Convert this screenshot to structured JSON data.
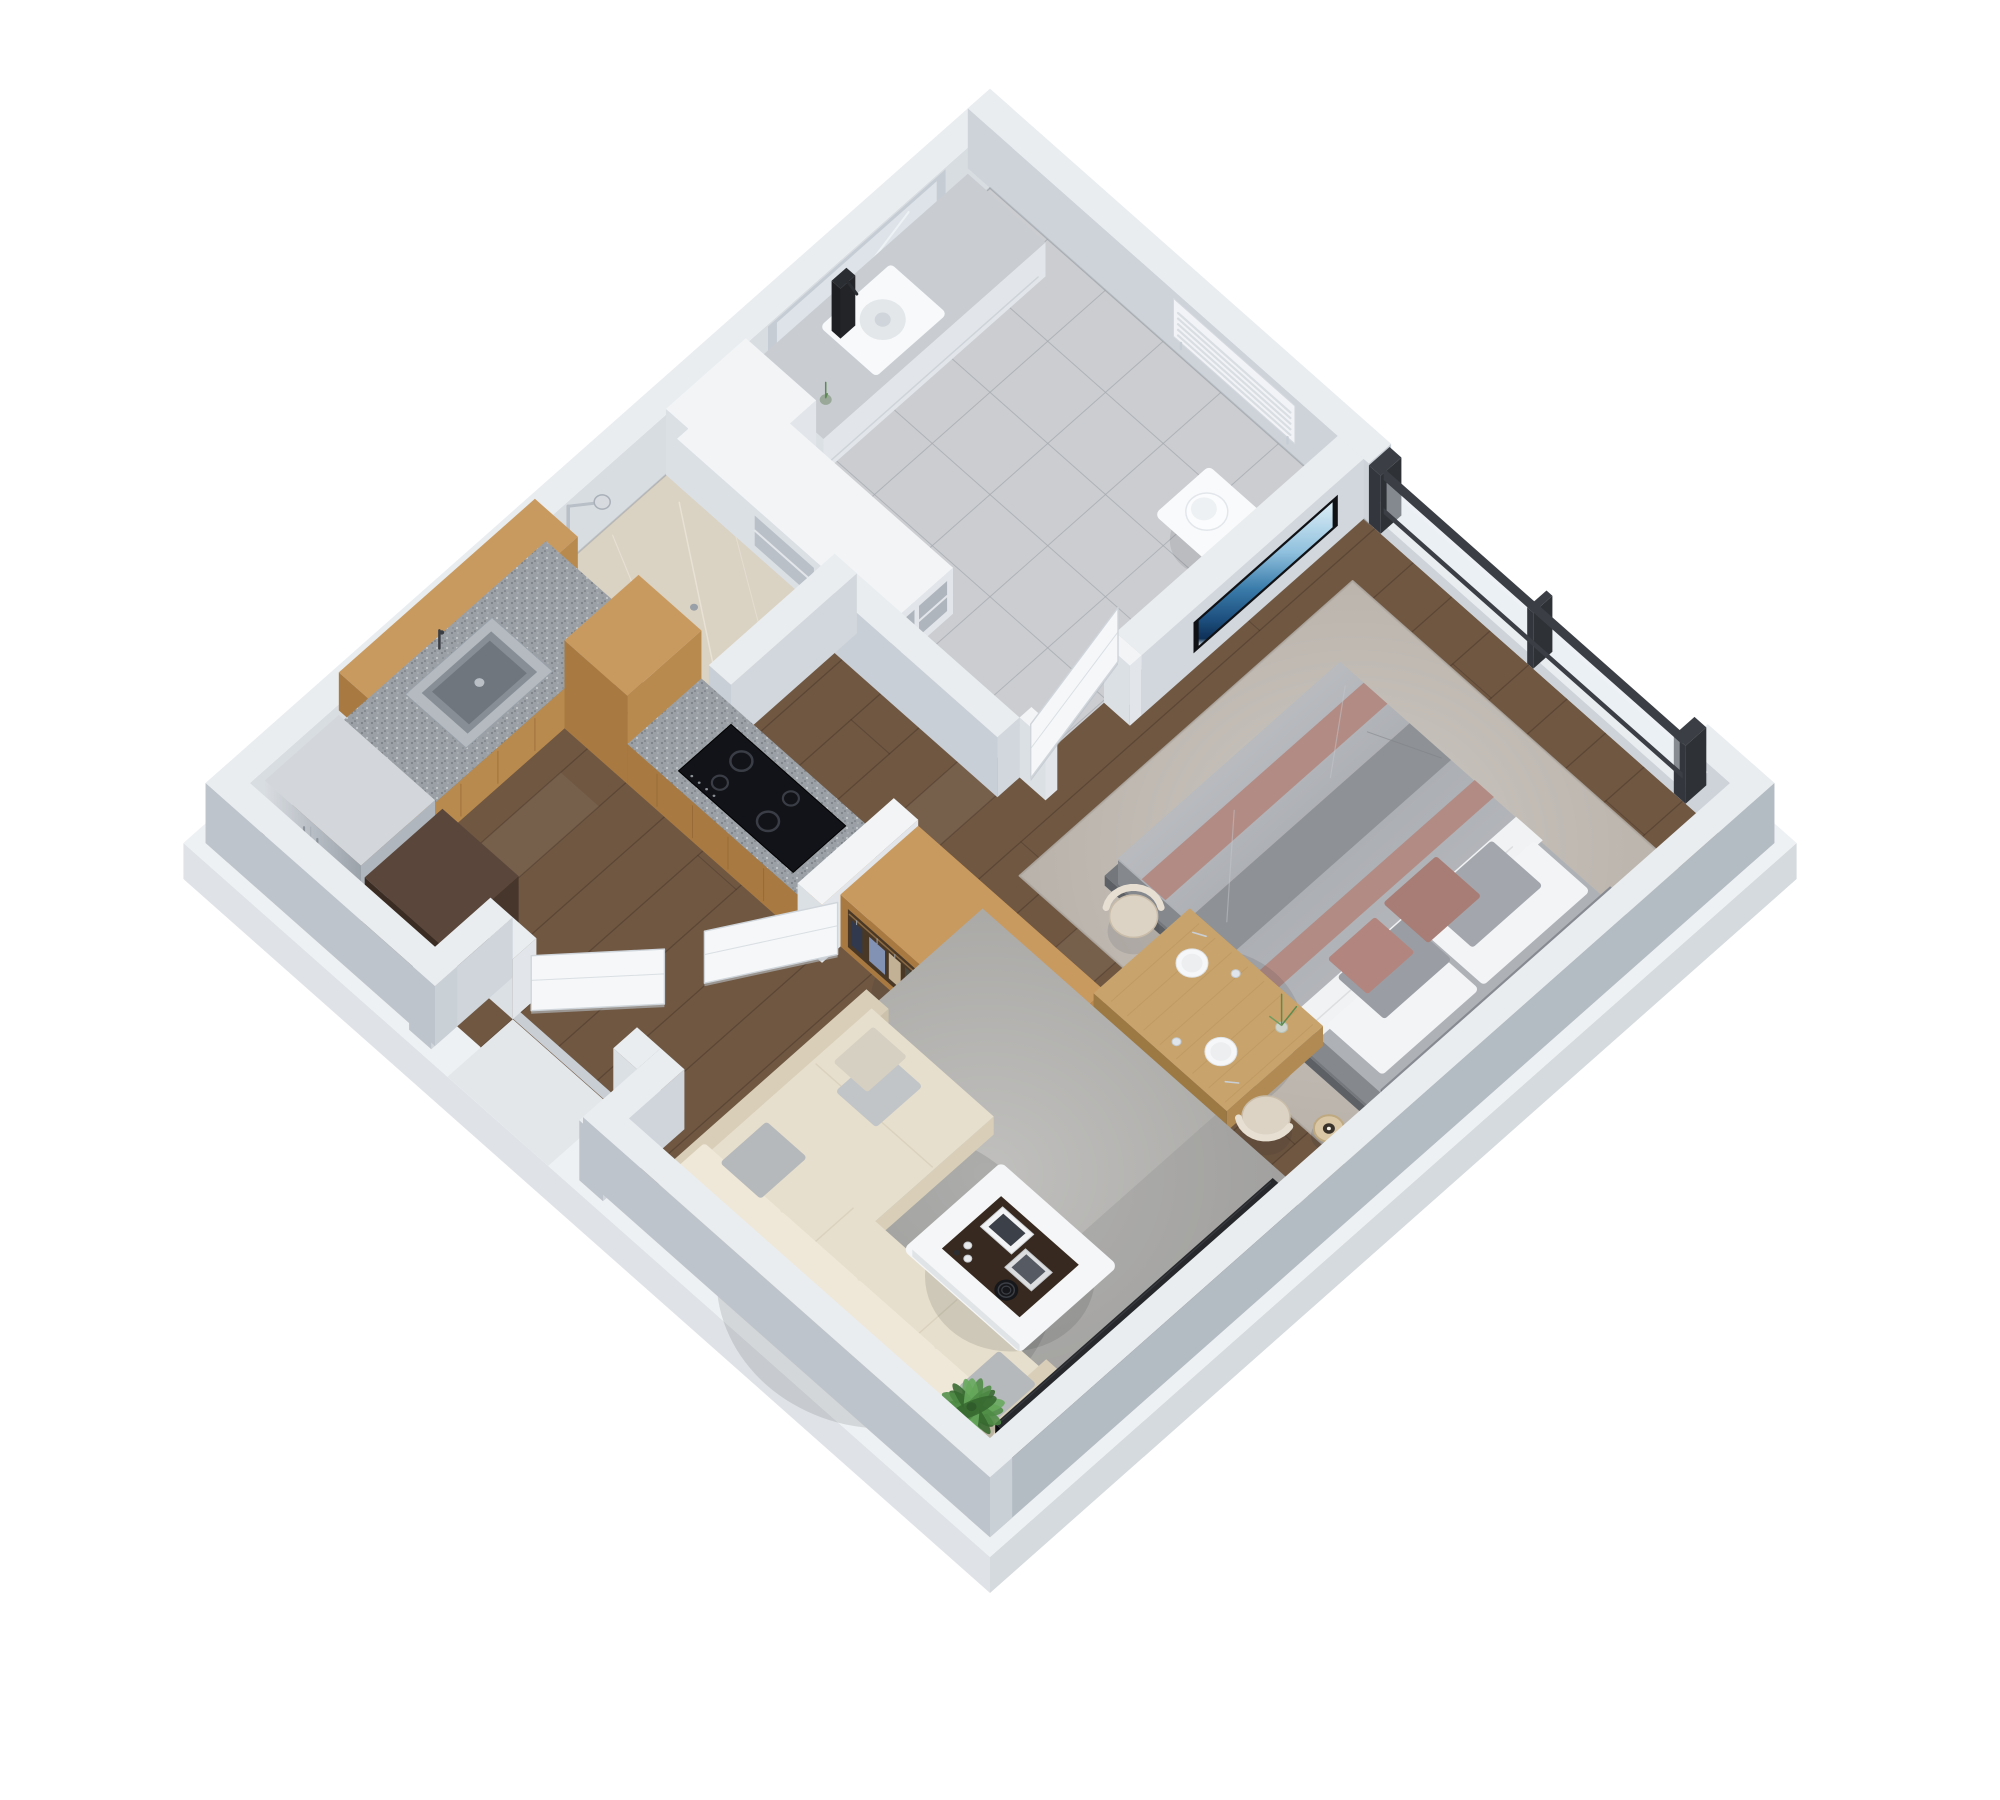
{
  "image": {
    "kind": "3d-isometric-floor-plan",
    "style": "photoreal architectural render, near top-down dimetric view, rotated 45 degrees",
    "background": "#ffffff"
  },
  "apartment": {
    "type": "studio apartment",
    "rooms": [
      {
        "id": "bathroom",
        "floor": "grey ceramic tile",
        "furniture": [
          "vanity-counter",
          "vessel-sink",
          "mirror-niche",
          "towel-radiator",
          "toilet",
          "shelf-unit",
          "walk-in-shower"
        ]
      },
      {
        "id": "kitchen",
        "floor": "dark wood plank",
        "furniture": [
          "l-shaped-oak-cabinets",
          "wall-cabinets",
          "granite-countertop",
          "kitchen-sink",
          "induction-cooktop",
          "refrigerator",
          "tall-appliance-column"
        ]
      },
      {
        "id": "closet",
        "floor": "dark wood plank",
        "furniture": [
          "open-oak-wardrobe",
          "hanging-clothes",
          "two-open-wardrobe-doors",
          "white-partition"
        ]
      },
      {
        "id": "bedroom",
        "floor": "dark wood plank",
        "furniture": [
          "double-bed",
          "grey-and-pink-bedding",
          "six-pillows",
          "headboard",
          "area-rug",
          "bedside-lamp",
          "wall-mounted-tv",
          "large-window"
        ]
      },
      {
        "id": "dining",
        "floor": "dark wood plank",
        "furniture": [
          "wooden-dining-table",
          "two-upholstered-chairs",
          "two-place-settings",
          "glasses",
          "plant-vase"
        ]
      },
      {
        "id": "living",
        "floor": "dark wood plank",
        "furniture": [
          "cream-corner-sofa",
          "grey-throw-pillows",
          "grey-area-rug",
          "white-coffee-table",
          "dark-tray-with-books-and-cups",
          "black-media-console",
          "potted-plant"
        ]
      },
      {
        "id": "entry",
        "floor": "dark wood plank",
        "furniture": [
          "recessed-entry-alcove",
          "open-entry-door"
        ]
      }
    ],
    "doors": [
      "entry-door-open",
      "bathroom-door-open",
      "wardrobe-door-left-open",
      "wardrobe-door-right-open"
    ],
    "window": {
      "location": "northeast wall, bedroom",
      "panes": 2,
      "frame": "dark grey aluminium"
    }
  },
  "scene": {
    "projection": {
      "ox": 990,
      "oy": 188,
      "ux": 0.74,
      "uy": 0.655,
      "vx": -0.74,
      "vy": 0.655,
      "wall_h": 60,
      "slab_depth": 36
    }
  },
  "palette": {
    "background": "#ffffff",
    "wall_top": "#e9edf0",
    "wall_inner_nw": "#d8dde2",
    "wall_inner_ne": "#cdd3d9",
    "wall_outer_se": "#b3bbc3",
    "wall_outer_sw": "#bdc4cb",
    "wall_cap": "#c9cfd6",
    "slab_top": "#eef1f3",
    "slab_face_se": "#d5dade",
    "slab_face_sw": "#dfe3e7",
    "tile": "#cbcdd1",
    "grout": "#a6aaaf",
    "marble": "#dad2c3",
    "marble_vein": "#efe9dc",
    "wood": "#6f5742",
    "wood_seam": "#3a281b",
    "oak_top": "#c99a5f",
    "oak_face": "#b98a4e",
    "oak_dark": "#a87a42",
    "oak_seam": "#8a5f2e",
    "counter": "#9aa0a5",
    "steel_top": "#d3d7db",
    "steel_face": "#b0b6bd",
    "dark_appliance": "#46362c",
    "dark_appliance2": "#3a2c23",
    "white": "#f2f4f6",
    "white_face": "#e2e6ea",
    "white_face2": "#dbe0e5",
    "cooktop": "#121318",
    "burner": "#3a3d45",
    "tv_frame": "#0f1115",
    "window_frame": "#3b3f45",
    "door": "#f5f7f9",
    "door_edge": "#cfd5da",
    "rug_bed": "#b5aea6",
    "rug_living": "#a3a29f",
    "bed_platform": "#74787d",
    "headboard": "#878b91",
    "duvet": "#a6a9ae",
    "duvet_dark": "#8e9196",
    "sheet": "#f0f2f3",
    "pink": "#b28b84",
    "pink_deep": "#a87d76",
    "pillow_grey": "#a3a7ad",
    "sofa": "#e7dfcd",
    "sofa_light": "#efe8d8",
    "sofa_dark": "#d9cfb9",
    "pillow_sofa": "#b6b9bb",
    "table_wood": "#c8a36b",
    "table_wood_face": "#b08a52",
    "chair": "#ddd3c4",
    "plate": "#f6f7f8",
    "coffee_white": "#f5f6f7",
    "tray": "#37291f",
    "tray_black": "#16171a",
    "console": "#26282c",
    "console_face": "#121316",
    "plant": "#4e8c46",
    "plant_dark": "#35682f",
    "plant_light": "#67a85c",
    "lamp": "#d9c7a6",
    "clothes": [
      "#30394e",
      "#8292b5",
      "#c2b194",
      "#49493f",
      "#2c3040",
      "#6b779a",
      "#9aa5bf",
      "#3a3f4b",
      "#b5a487",
      "#565d6a"
    ]
  }
}
